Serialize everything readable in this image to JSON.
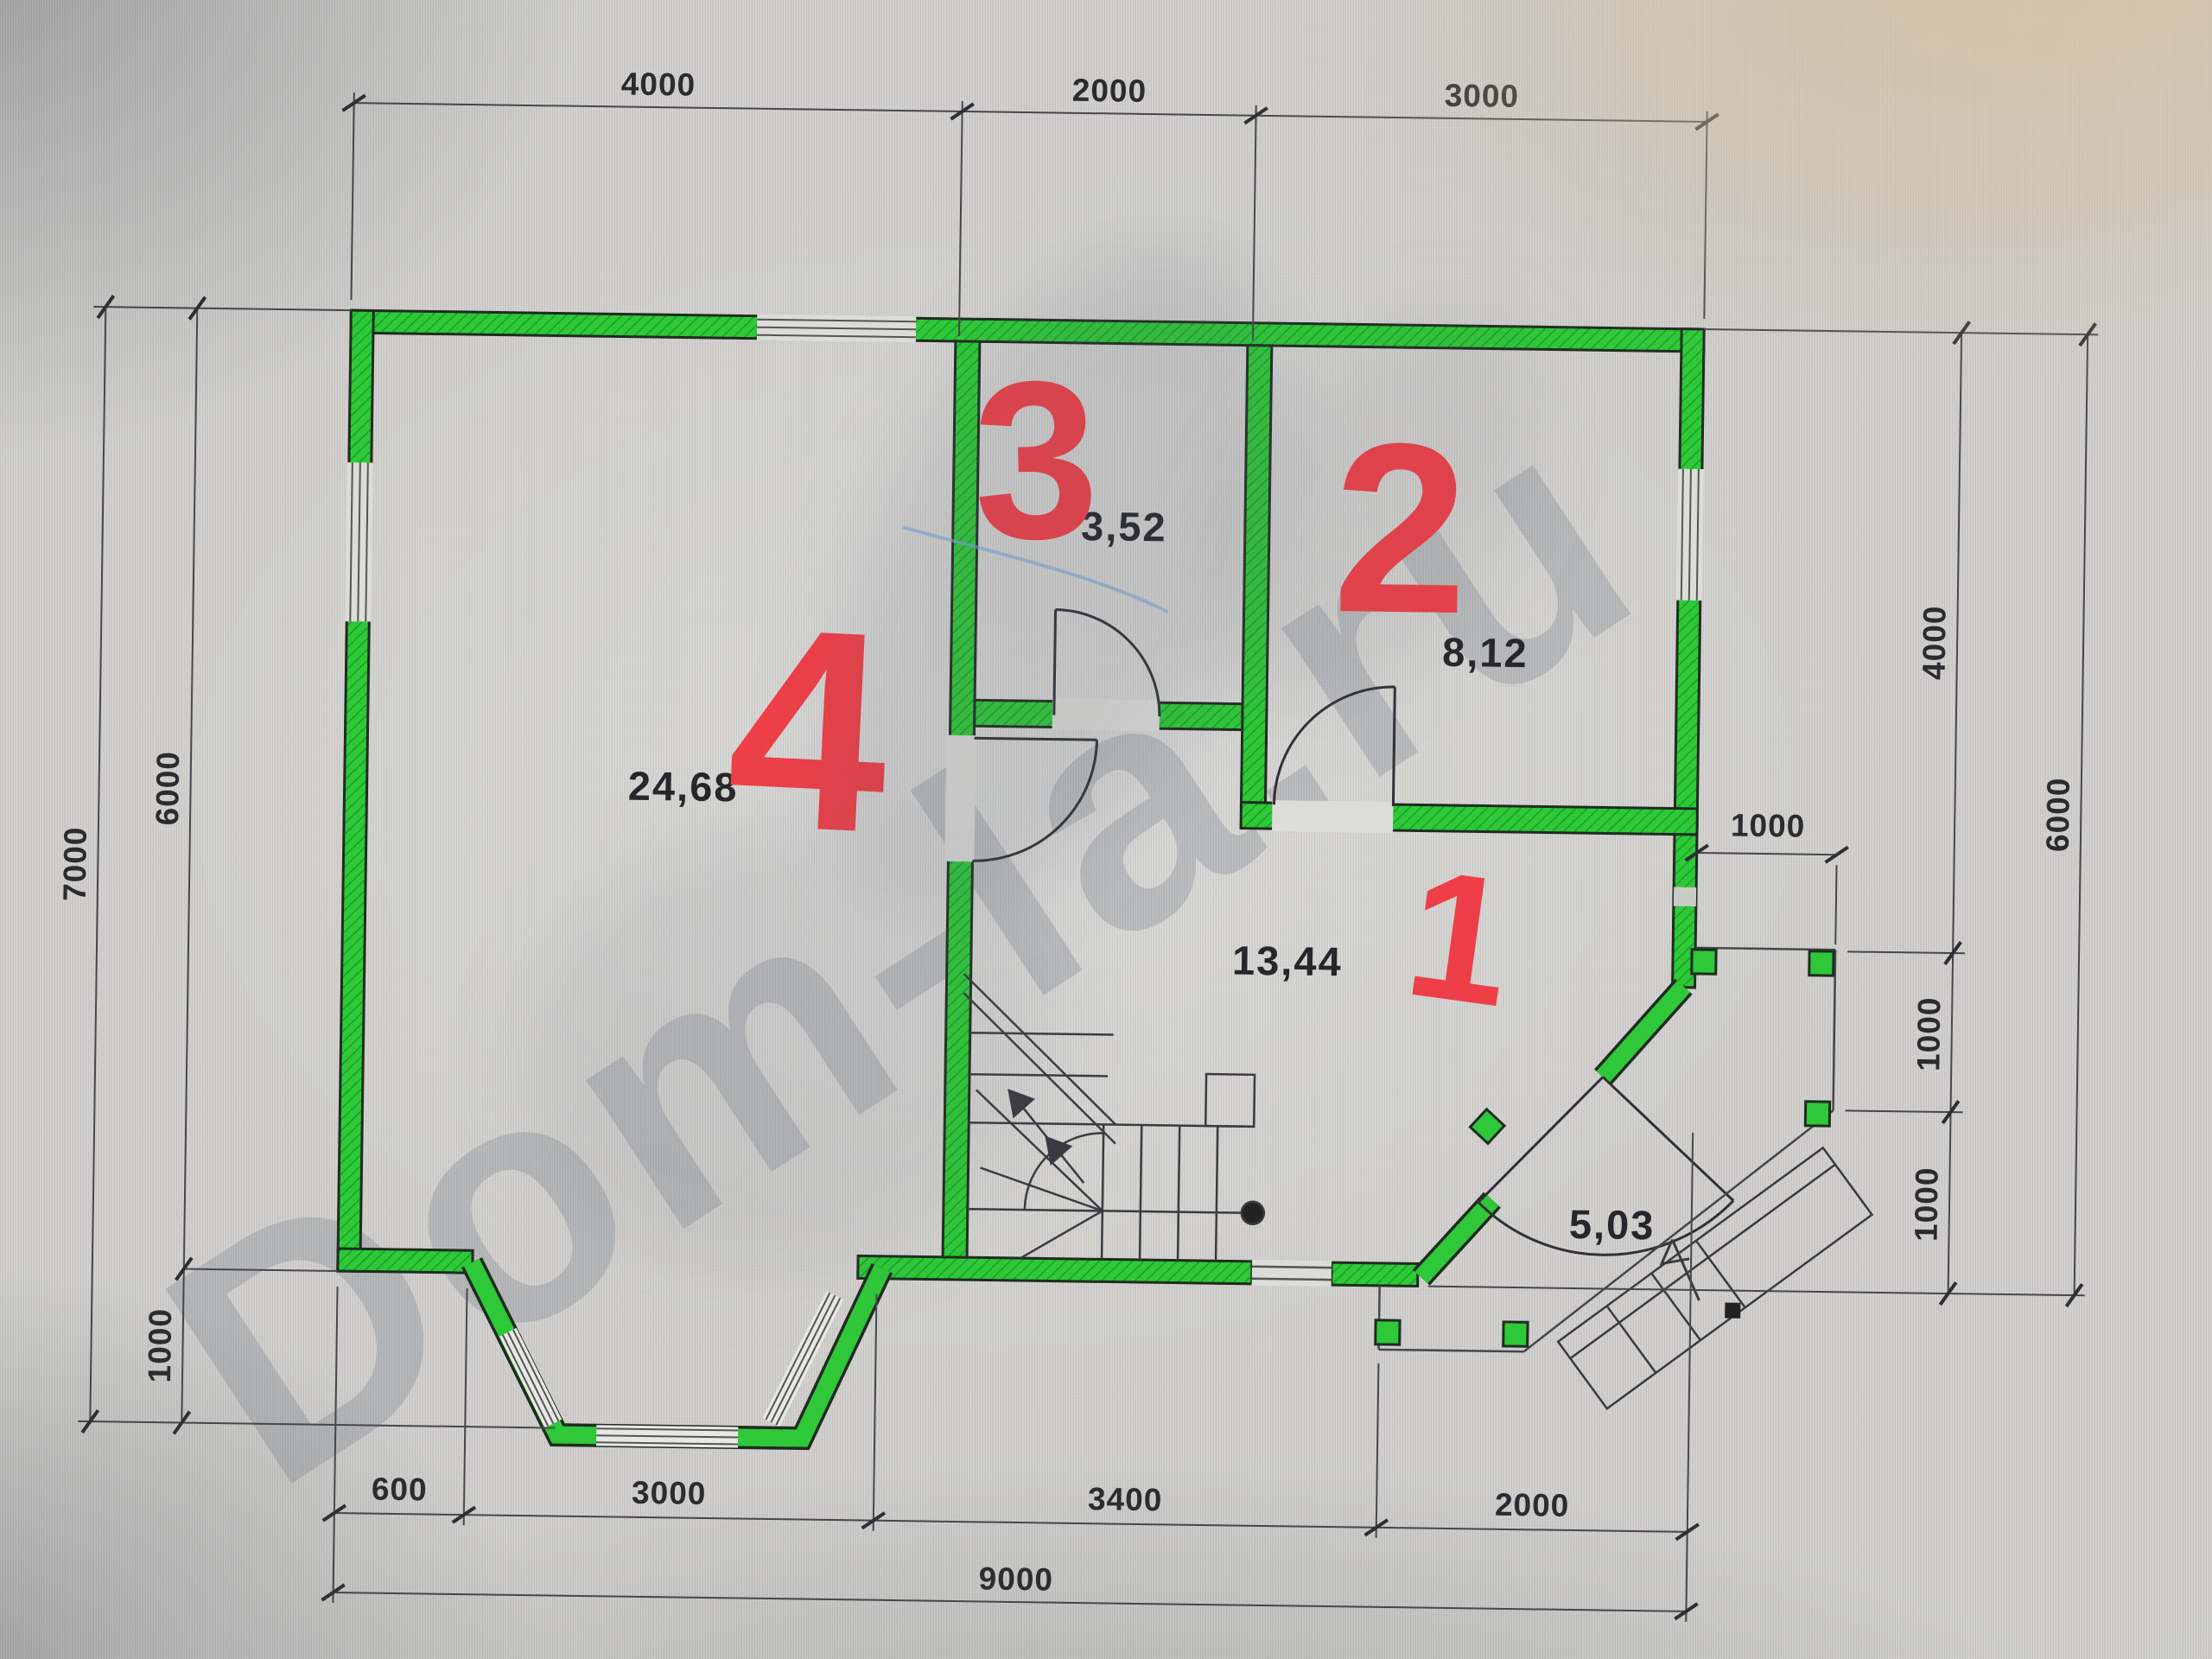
{
  "watermark": "Dom-la.ru",
  "plan_title": "first-floor-plan",
  "colors": {
    "wall_green": "#2ec838",
    "annotation_red": "#ee3e47",
    "line_dark": "#3a3a40"
  },
  "areas": {
    "room1": "13,44",
    "room2": "8,12",
    "room3": "3,52",
    "room4": "24,68",
    "porch": "5,03"
  },
  "marks": {
    "m1": "1",
    "m2": "2",
    "m3": "3",
    "m4": "4"
  },
  "dims": {
    "top": [
      "4000",
      "2000",
      "3000"
    ],
    "left_outer": "7000",
    "left_inner": [
      "6000",
      "1000"
    ],
    "right_inner": [
      "4000",
      "1000",
      "1000"
    ],
    "right_outer": "6000",
    "porch_width": "1000",
    "bottom": [
      "600",
      "3000",
      "3400",
      "2000"
    ],
    "bottom_total": "9000"
  }
}
